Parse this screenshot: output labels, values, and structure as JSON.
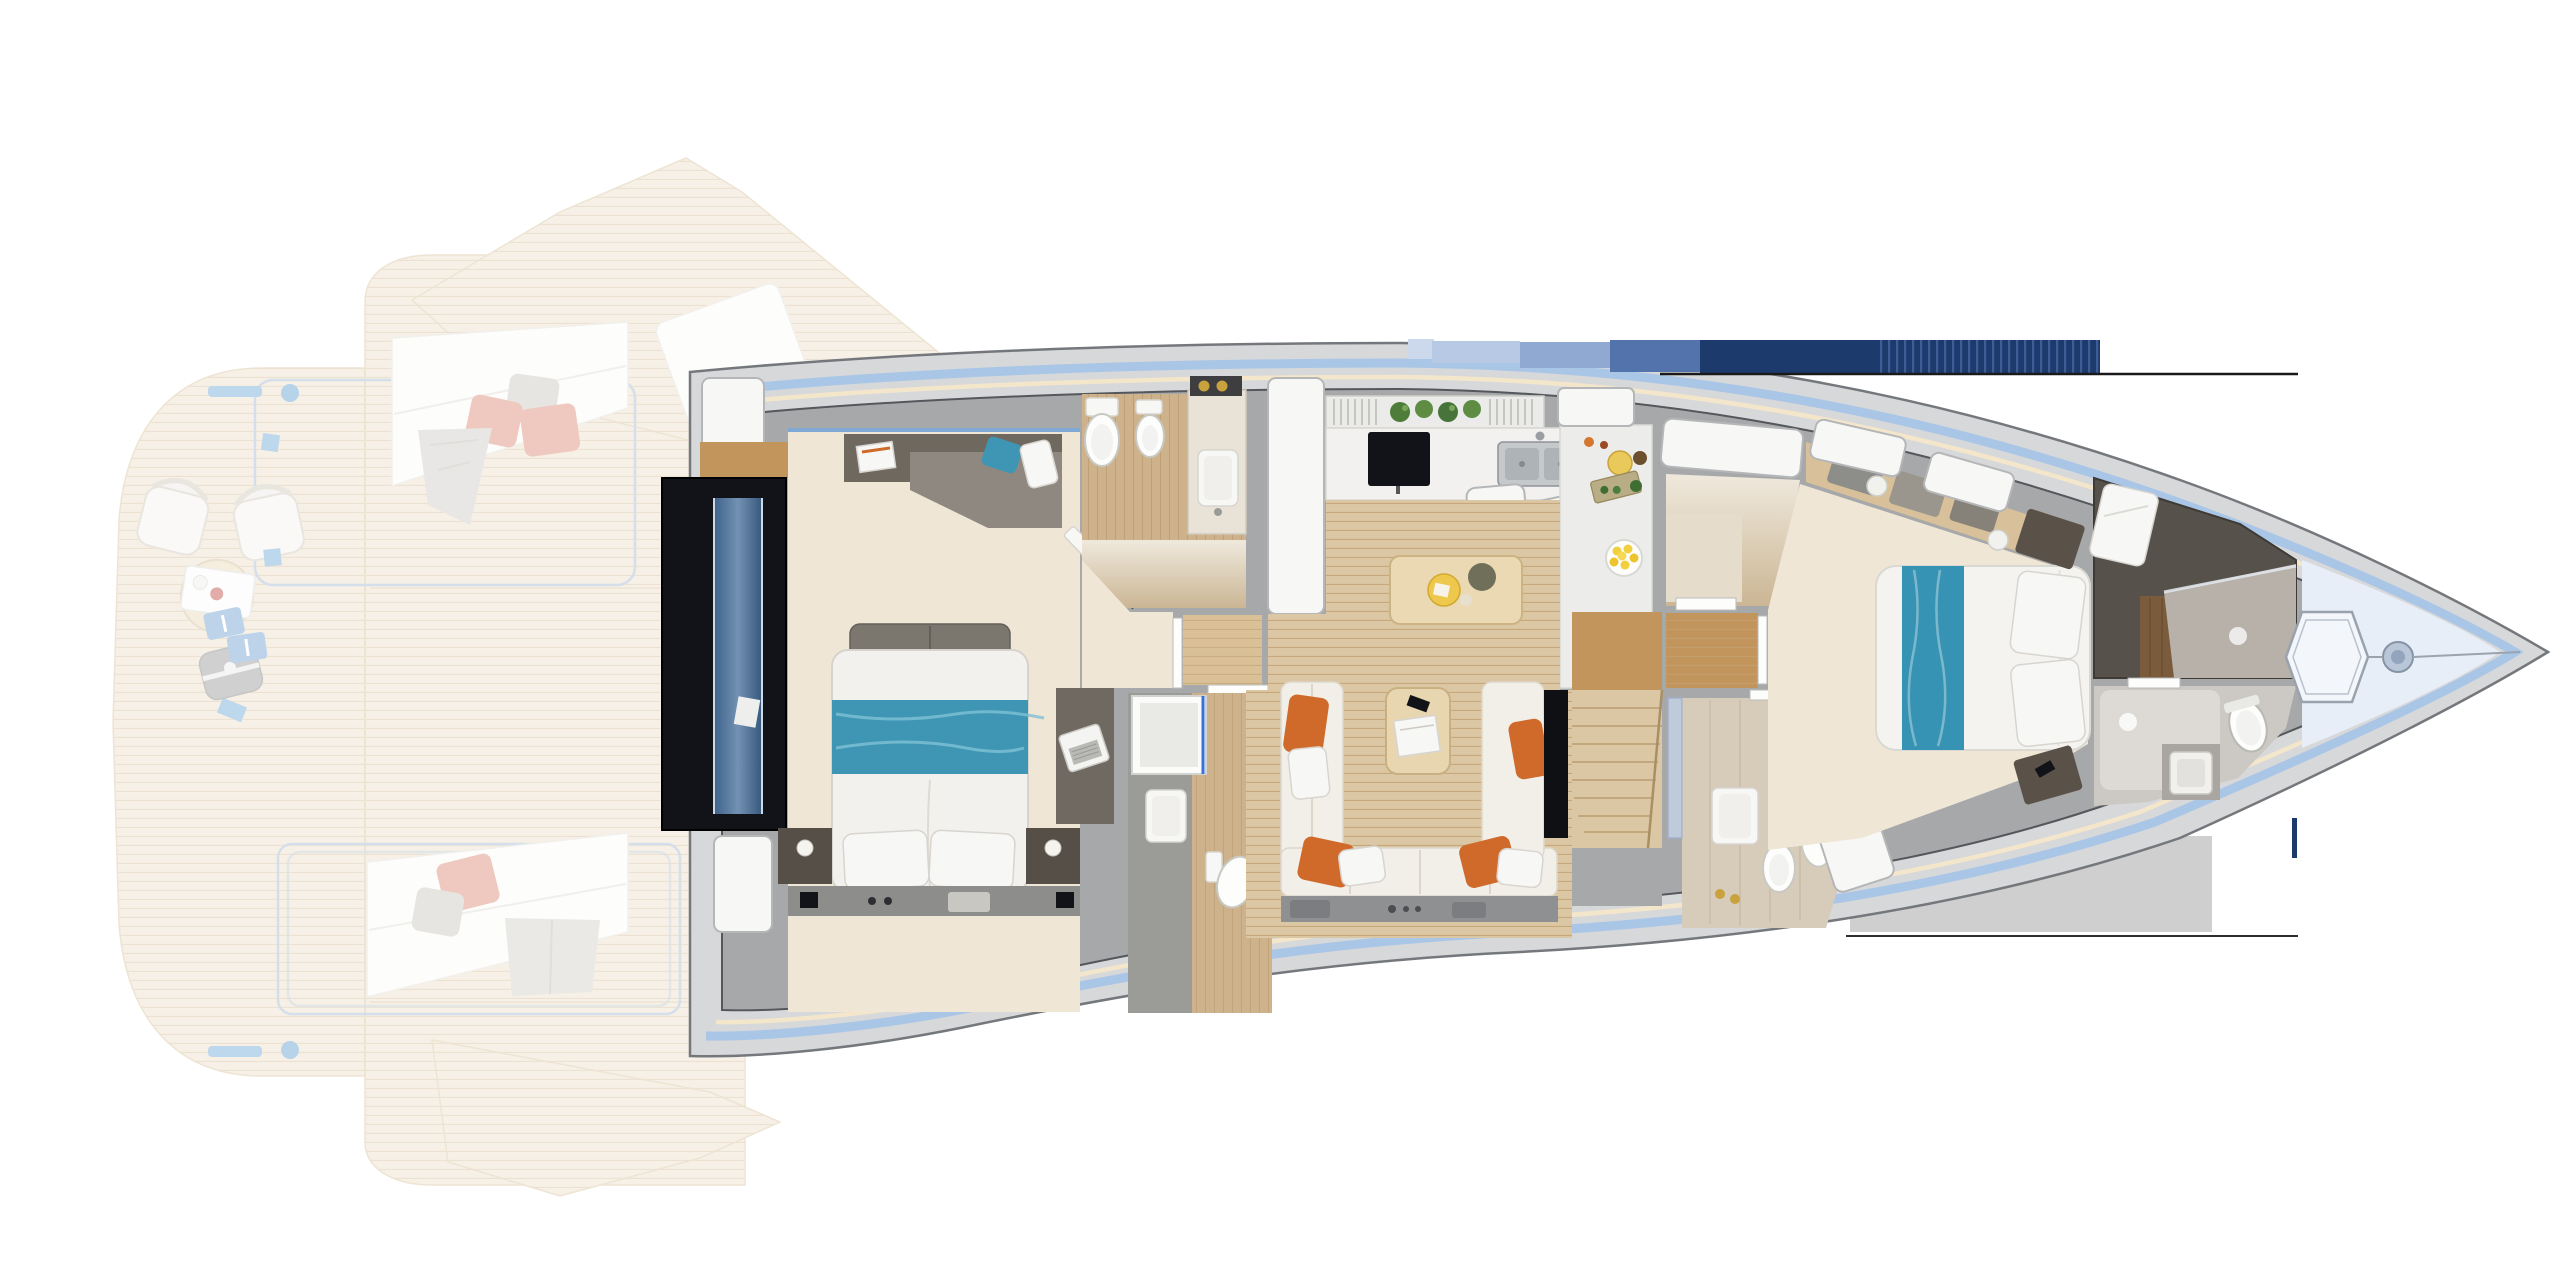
{
  "title": "Motor yacht lower-deck floor plan — top view rendering, bow to the right",
  "image_type": "floor-plan",
  "orientation": {
    "bow": "right",
    "stern": "left",
    "aft_exterior": "faded overlay at left"
  },
  "palette": {
    "page-bg": "#ffffff",
    "hull-shell": "#d7d8da",
    "hull-line": "#74777b",
    "stripe-blue": "#aac6e6",
    "stripe-cream": "#f4e6cb",
    "wall": "#a7a8a9",
    "wall-line": "#54575b",
    "floor-cream": "#efe6d6",
    "floor-wood": "#dcc7a4",
    "floor-wood-dark": "#c2955c",
    "floor-dress": "#d9c096",
    "floor-tile": "#d7cbba",
    "floor-bath-wood": "#cdb28b",
    "deck-faded": "#ecdfc8",
    "deck-line": "#d9c4a0",
    "deck-blue": "#6fa8d6",
    "rail-blue": "#a3b8d4",
    "furn-white": "#f7f7f5",
    "furn-line": "#d8d5d0",
    "sofa-gray": "#8e8880",
    "sofa-dark": "#6e685f",
    "sofa-cream": "#f2efe8",
    "pillow-gray": "#c9c6c0",
    "teal": "#3e96b4",
    "orange": "#cf6a2a",
    "coral": "#dd8a72",
    "navy": "#1d3a6d",
    "steel": "#c6c9cc",
    "dark-panel": "#121318",
    "glass-blue": "#5b82b8",
    "table-wood": "#ead9b2",
    "plant-green": "#4e7d3a",
    "lemon-yellow": "#f2cf3d",
    "gold": "#c9a23e",
    "bath-dark": "#57514b",
    "bath-brown": "#7a5c3c",
    "bow-pale": "#e8eef7"
  },
  "sections": {
    "aft_exterior": {
      "rendering": "semi-transparent",
      "areas": [
        "swim-platform",
        "aft-cockpit-deck",
        "port-wing-sun-pad",
        "starboard-wing-sun-pad"
      ],
      "furniture": [
        "deck-chair",
        "deck-chair",
        "round-coffee-table",
        "serving-tray",
        "beach-bag",
        "step-mats",
        "blue-deck-pads",
        "mooring-cleats"
      ],
      "pillow_colors": [
        "coral",
        "coral",
        "gray"
      ]
    },
    "accommodation": {
      "rooms": [
        {
          "name": "stair-lobby",
          "features": [
            "staircase-down",
            "blue-glass-panel",
            "hull-windows"
          ]
        },
        {
          "name": "master-cabin",
          "furniture": [
            "double-bed",
            "teal-bed-throw",
            "two-pillows",
            "lounge-sofa",
            "teal-pillow",
            "side-table-with-book",
            "two-nightstands-with-lamps",
            "desk",
            "laptop"
          ]
        },
        {
          "name": "guest-bathroom",
          "fixtures": [
            "toilet",
            "bidet",
            "vanity-vessel-sink",
            "gold-fittings",
            "glass-door"
          ]
        },
        {
          "name": "master-bathroom",
          "fixtures": [
            "walk-in-shower",
            "vanity-sink",
            "toilet"
          ]
        },
        {
          "name": "galley",
          "equipment": [
            "tall-fridge-cabinet",
            "tv",
            "double-stainless-sink",
            "herb-plants",
            "vent-grilles",
            "cutting-board",
            "lemon-bowl",
            "counter-column"
          ]
        },
        {
          "name": "dining-area",
          "furniture": [
            "wood-dining-table",
            "serving-tray",
            "round-platter"
          ]
        },
        {
          "name": "salon",
          "furniture": [
            "u-shaped-cream-sofa",
            "coffee-table-with-magazines",
            "phone",
            "tv-cabinet"
          ],
          "pillow_colors": [
            "orange",
            "white",
            "orange",
            "white",
            "orange",
            "orange"
          ]
        },
        {
          "name": "staircase-to-main-deck",
          "features": [
            "fan-steps",
            "wood-treads"
          ]
        },
        {
          "name": "day-head",
          "fixtures": [
            "glass-partition",
            "sink",
            "toilet",
            "bidet",
            "gold-fittings"
          ]
        },
        {
          "name": "forward-dressing-corridor",
          "features": [
            "wood-floor",
            "door-gaps"
          ]
        },
        {
          "name": "forward-closet-room",
          "features": [
            "deck-hatch-window",
            "rug"
          ]
        },
        {
          "name": "vip-cabin",
          "furniture": [
            "double-bed",
            "teal-runner",
            "two-pillows",
            "two-nightstands",
            "wardrobe-band-with-towels",
            "phone"
          ]
        },
        {
          "name": "forward-bathroom",
          "fixtures": [
            "dark-shower-room",
            "towels",
            "wood-cabinet",
            "toilet",
            "square-sink"
          ]
        }
      ]
    },
    "bow": {
      "features": [
        "anchor-locker-hatch",
        "windlass",
        "bow-deck",
        "pale-blue-liner"
      ]
    },
    "print_artifacts": [
      "navy-banded-strip-top",
      "thin-rule-lines",
      "gray-shadow-rectangle",
      "navy-tick"
    ]
  }
}
